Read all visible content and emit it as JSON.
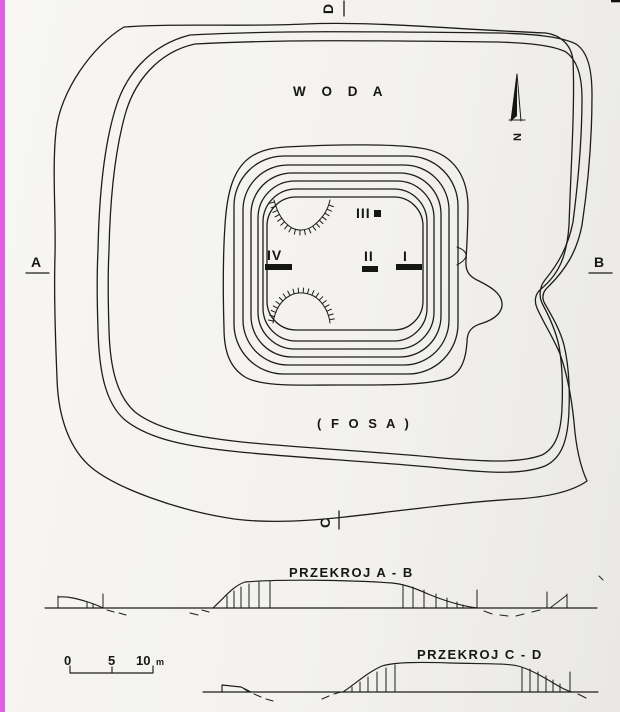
{
  "scan": {
    "paper_color": "#f3f2ef",
    "left_edge_color": "#e25fe4",
    "ink_color": "#1d1d1b"
  },
  "plan": {
    "water_label": "W O D A",
    "moat_label": "( F O S A )",
    "north_label": "N",
    "section_markers": {
      "a": "A",
      "b": "B",
      "c": "C",
      "d": "D"
    },
    "trenches": {
      "t1": "I",
      "t2": "II",
      "t3": "III",
      "t4": "IV"
    }
  },
  "sections": {
    "ab_title": "PRZEKROJ  A - B",
    "cd_title": "PRZEKROJ  C - D"
  },
  "scale_bar": {
    "t0": "0",
    "t5": "5",
    "t10": "10",
    "unit": "m"
  }
}
